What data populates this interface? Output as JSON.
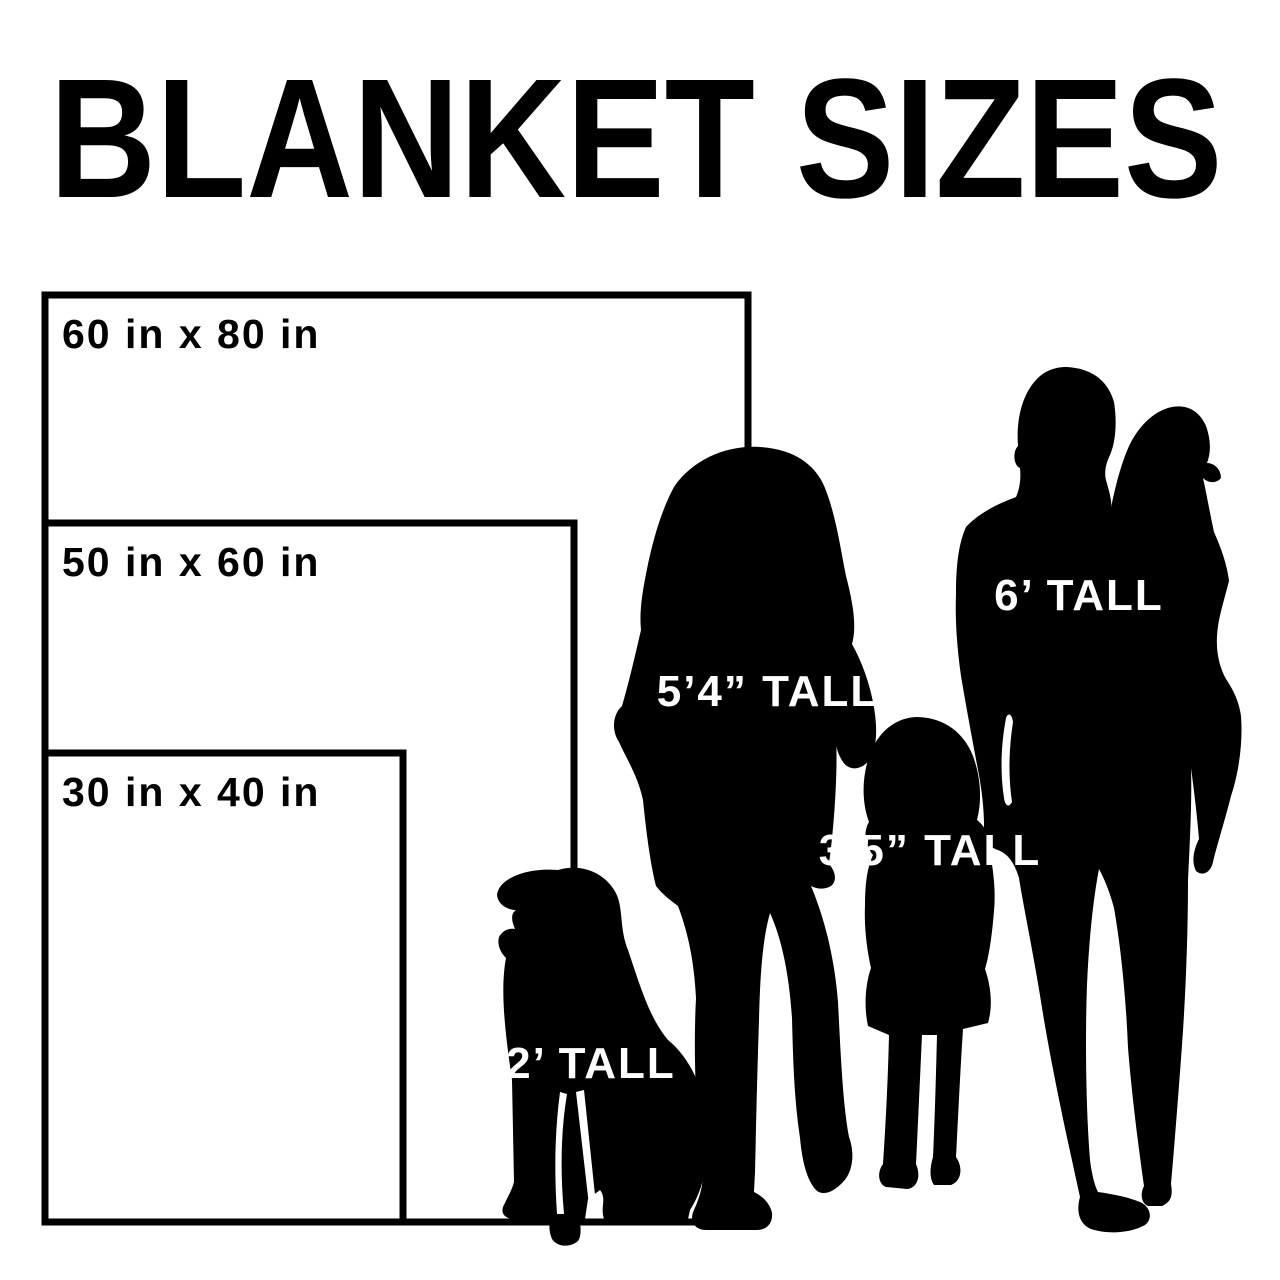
{
  "title": "BLANKET SIZES",
  "blankets": [
    {
      "name": "large",
      "label": "60 in x 80 in",
      "width_in": 60,
      "height_in": 80
    },
    {
      "name": "medium",
      "label": "50 in x 60 in",
      "width_in": 50,
      "height_in": 60
    },
    {
      "name": "small",
      "label": "30 in x 40 in",
      "width_in": 30,
      "height_in": 40
    }
  ],
  "figures": [
    {
      "name": "dog",
      "height_label": "2’ TALL"
    },
    {
      "name": "woman",
      "height_label": "5’4” TALL"
    },
    {
      "name": "girl",
      "height_label": "3’5” TALL"
    },
    {
      "name": "man",
      "height_label": "6’ TALL"
    }
  ],
  "colors": {
    "background": "#ffffff",
    "ink": "#000000",
    "silhouette_label": "#ffffff"
  }
}
